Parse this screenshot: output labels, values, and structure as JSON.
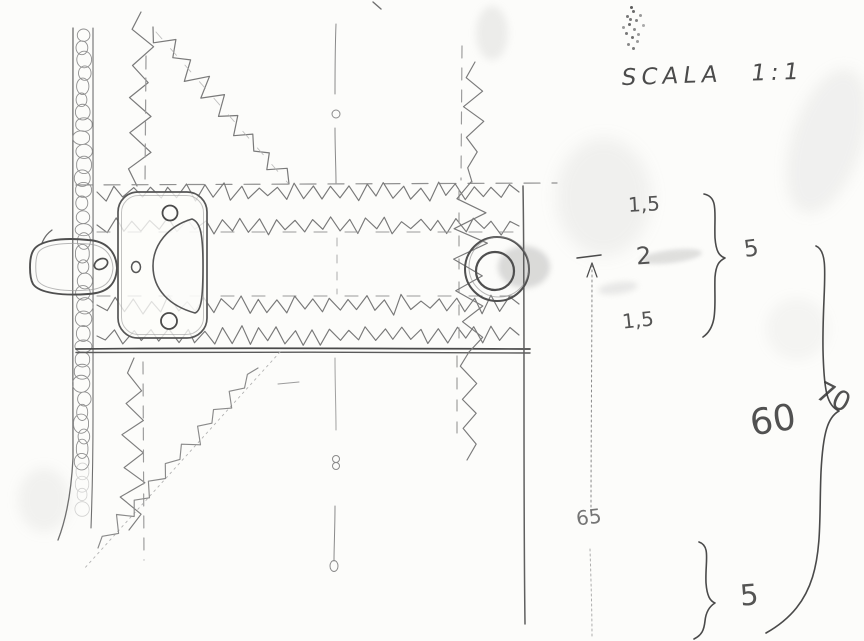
{
  "drawing": {
    "scale_label": "SCALA 1:1",
    "dimensions": {
      "top_stack": [
        "1,5",
        "2",
        "1,5"
      ],
      "top_stack_total": "5",
      "middle_segment": "60",
      "overall": "70",
      "vertical_reference": "65",
      "bottom_segment": "5"
    }
  },
  "colors": {
    "paper": "#fcfcfa",
    "pencil": "#6f6f6f",
    "pencil_dark": "#474747",
    "pencil_faint": "#a0a0a0"
  }
}
